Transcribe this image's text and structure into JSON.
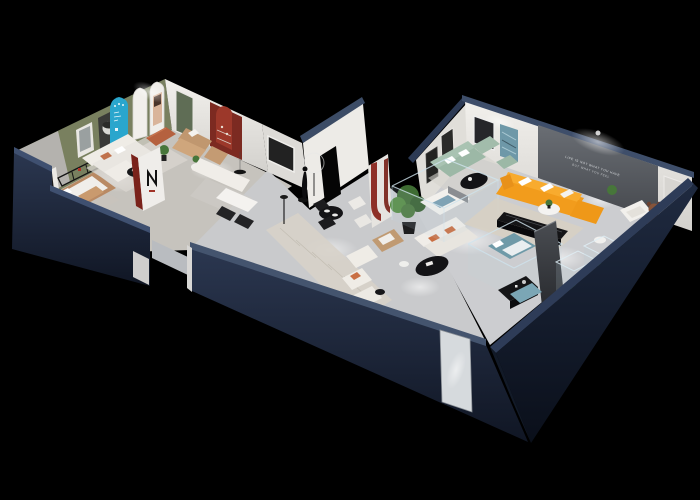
{
  "scene": {
    "type": "isometric-dollhouse-floorplan-render",
    "background": "#000000",
    "wall_slogan": {
      "line1": "LIFE IS NOT WHAT YOU HAVE",
      "line2": "BUT WHAT YOU FEEL"
    },
    "palette": {
      "wall_top_band": "#44546e",
      "wall_navy": "#232e45",
      "wall_navy_dark": "#161e2e",
      "wall_white": "#e9e7e3",
      "floor_gray": "#cbccce",
      "accent_olive": "#79805f",
      "accent_cyan": "#2aa6cd",
      "accent_red": "#8e3028",
      "green_door": "#5f6d55",
      "sofa_orange": "#f29c1c",
      "sofa_mint": "#a9c3b2",
      "sofa_cream": "#efece6",
      "leather_tan": "#b98a64",
      "plant_green": "#47763a",
      "accent_panel_gray": "#5c6066",
      "glass_blue": "#bcd4e2"
    }
  }
}
